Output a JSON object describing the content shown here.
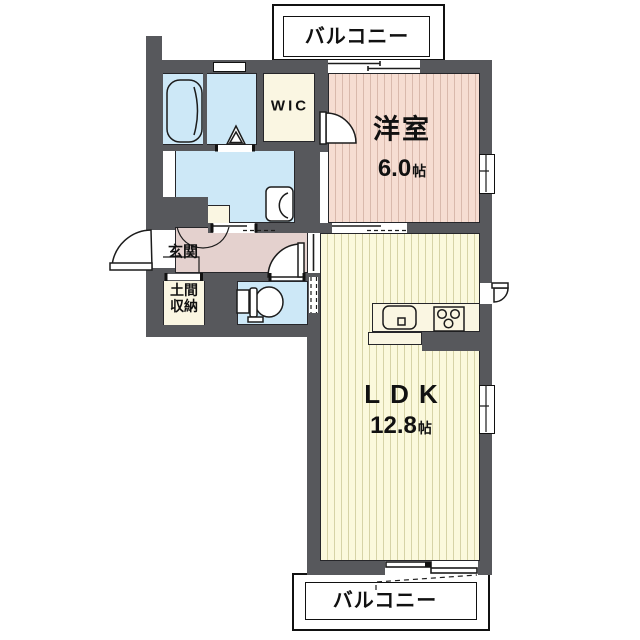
{
  "balcony_top": {
    "label": "バルコニー"
  },
  "balcony_bottom": {
    "label": "バルコニー"
  },
  "rooms": {
    "western_room": {
      "name": "洋室",
      "size_value": "6.0",
      "size_unit": "帖"
    },
    "ldk": {
      "name": "LDK",
      "size_value": "12.8",
      "size_unit": "帖"
    },
    "wic": {
      "label": "WIC"
    },
    "entrance": {
      "label": "玄関"
    },
    "doma_storage": {
      "line1": "土間",
      "line2": "収納"
    }
  },
  "colors": {
    "wall": "#57585c",
    "western_room_floor": "#f6ddd2",
    "western_room_stripe": "#d9b9ac",
    "ldk_floor": "#fbf9dc",
    "ldk_stripe": "#d6d3a6",
    "wet_area_floor": "#cde8f7",
    "hallway_floor": "#e4d1ce",
    "closet_floor": "#faf6e2",
    "outline": "#111111"
  }
}
